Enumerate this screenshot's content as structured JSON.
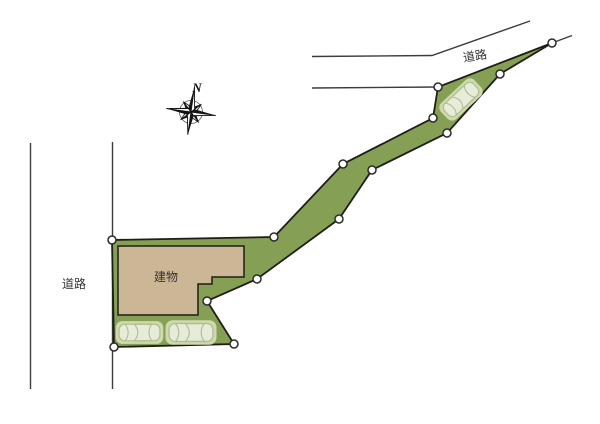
{
  "labels": {
    "road_top": "道路",
    "road_left": "道路",
    "building": "建物",
    "north": "N"
  },
  "colors": {
    "background": "#ffffff",
    "parcel_green": "#85a055",
    "parcel_outline": "#1e1e14",
    "building_tan": "#cbb795",
    "building_outline": "#1e1e14",
    "road_line": "#3c3c3c",
    "car_pad": "#cfd9ae",
    "car_body": "#e7ebd9",
    "car_line": "#adbb8e",
    "vertex_fill": "#ffffff",
    "vertex_stroke": "#2b2b2b",
    "compass_ink": "#141414",
    "label_text": "#333333"
  }
}
